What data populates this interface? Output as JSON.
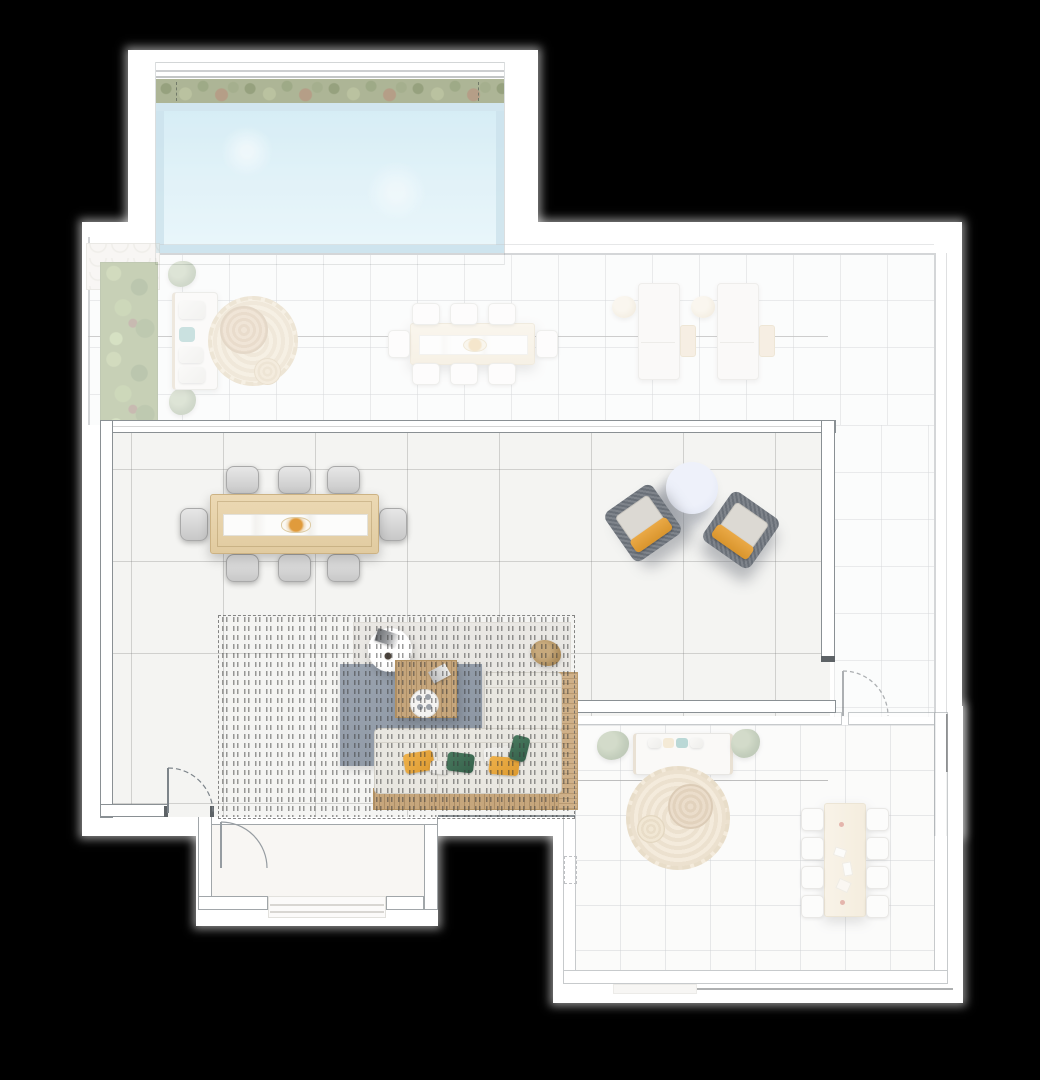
{
  "scene": {
    "title": "Apartment floor plan — top-down 3D render",
    "view": "top-down",
    "background_color": "#000000",
    "paper_color": "#ffffff",
    "focus_area": "living-dining-room",
    "muted_areas": [
      "pool-terrace",
      "upper-terrace",
      "east-terrace",
      "lower-suite"
    ]
  },
  "rooms": [
    {
      "id": "pool-terrace",
      "label": "Swimming pool",
      "state": "muted",
      "elements": [
        "pool-water",
        "hedge-planter-strip",
        "pool-deck-frame",
        "pool-edge-tile-band",
        "expansion-joint-ticks"
      ]
    },
    {
      "id": "upper-terrace",
      "label": "Upper terrace",
      "state": "muted",
      "elements": [
        "planter-strip",
        "stone-paving",
        "garden-sofa",
        "round-jute-rug",
        "rattan-coffee-table",
        "pouf",
        "outdoor-dining-table",
        "potted-plants",
        "sun-loungers",
        "lounger-side-tables",
        "overhang-line"
      ],
      "outdoor_dining_chair_count": 8,
      "sun_lounger_count": 2
    },
    {
      "id": "living-dining-room",
      "label": "Living / dining room",
      "state": "focused",
      "elements": [
        "dining-table",
        "serving-platter",
        "dining-chairs",
        "armchair-pair",
        "round-side-table",
        "rug-light",
        "rug-grey",
        "white-side-table",
        "magazines",
        "coffee-cup",
        "slatted-coffee-table",
        "serving-tray",
        "l-shaped-sofa",
        "wood-sofa-frame",
        "throw-pillows",
        "driftwood-plant",
        "pergola-slat-overlay",
        "door-swings"
      ],
      "dining_chair_count": 8,
      "armchair_count": 2,
      "pillow_colors": [
        "amber",
        "green",
        "white"
      ]
    },
    {
      "id": "east-terrace",
      "label": "Side terrace",
      "state": "muted",
      "elements": [
        "tile-floor",
        "door-swing"
      ]
    },
    {
      "id": "entry-vestibule",
      "label": "Entry vestibule",
      "state": "neutral",
      "elements": [
        "door-swing",
        "entry-porch-steps"
      ]
    },
    {
      "id": "lower-suite",
      "label": "Lower suite",
      "state": "muted",
      "elements": [
        "daybed",
        "potted-plants",
        "round-jute-rug",
        "rattan-coffee-table",
        "pouf",
        "dining-table",
        "dining-chairs",
        "shaft-symbol",
        "balcony-edge-line"
      ],
      "dining_chair_count": 8
    }
  ],
  "palette": {
    "background": "#000000",
    "paper": "#ffffff",
    "wall_line": "#8a9094",
    "wall_line_dark": "#4c4f52",
    "pool_water": "#d5edf6",
    "pool_edge_tile": "#bddae7",
    "greenery": "#7c9154",
    "hedge_olive": "#99a37c",
    "stone_paving": "#efece5",
    "tile_floor": "#f6f7f7",
    "main_floor": "#f4f4f2",
    "wood_light": "#e8d5ae",
    "wood_slats": "#c6a67c",
    "jute": "#ddc9a8",
    "chair_grey": "#d4d4d4",
    "chair_white": "#fbfaf8",
    "sofa_fabric": "#e9e7e1",
    "rug_grey_blue": "#96a0ac",
    "pillow_amber": "#e4a43c",
    "pillow_green": "#3f6a51",
    "accent_table_blue": "#e4e8f5",
    "teal_cushion": "#83bab6"
  }
}
